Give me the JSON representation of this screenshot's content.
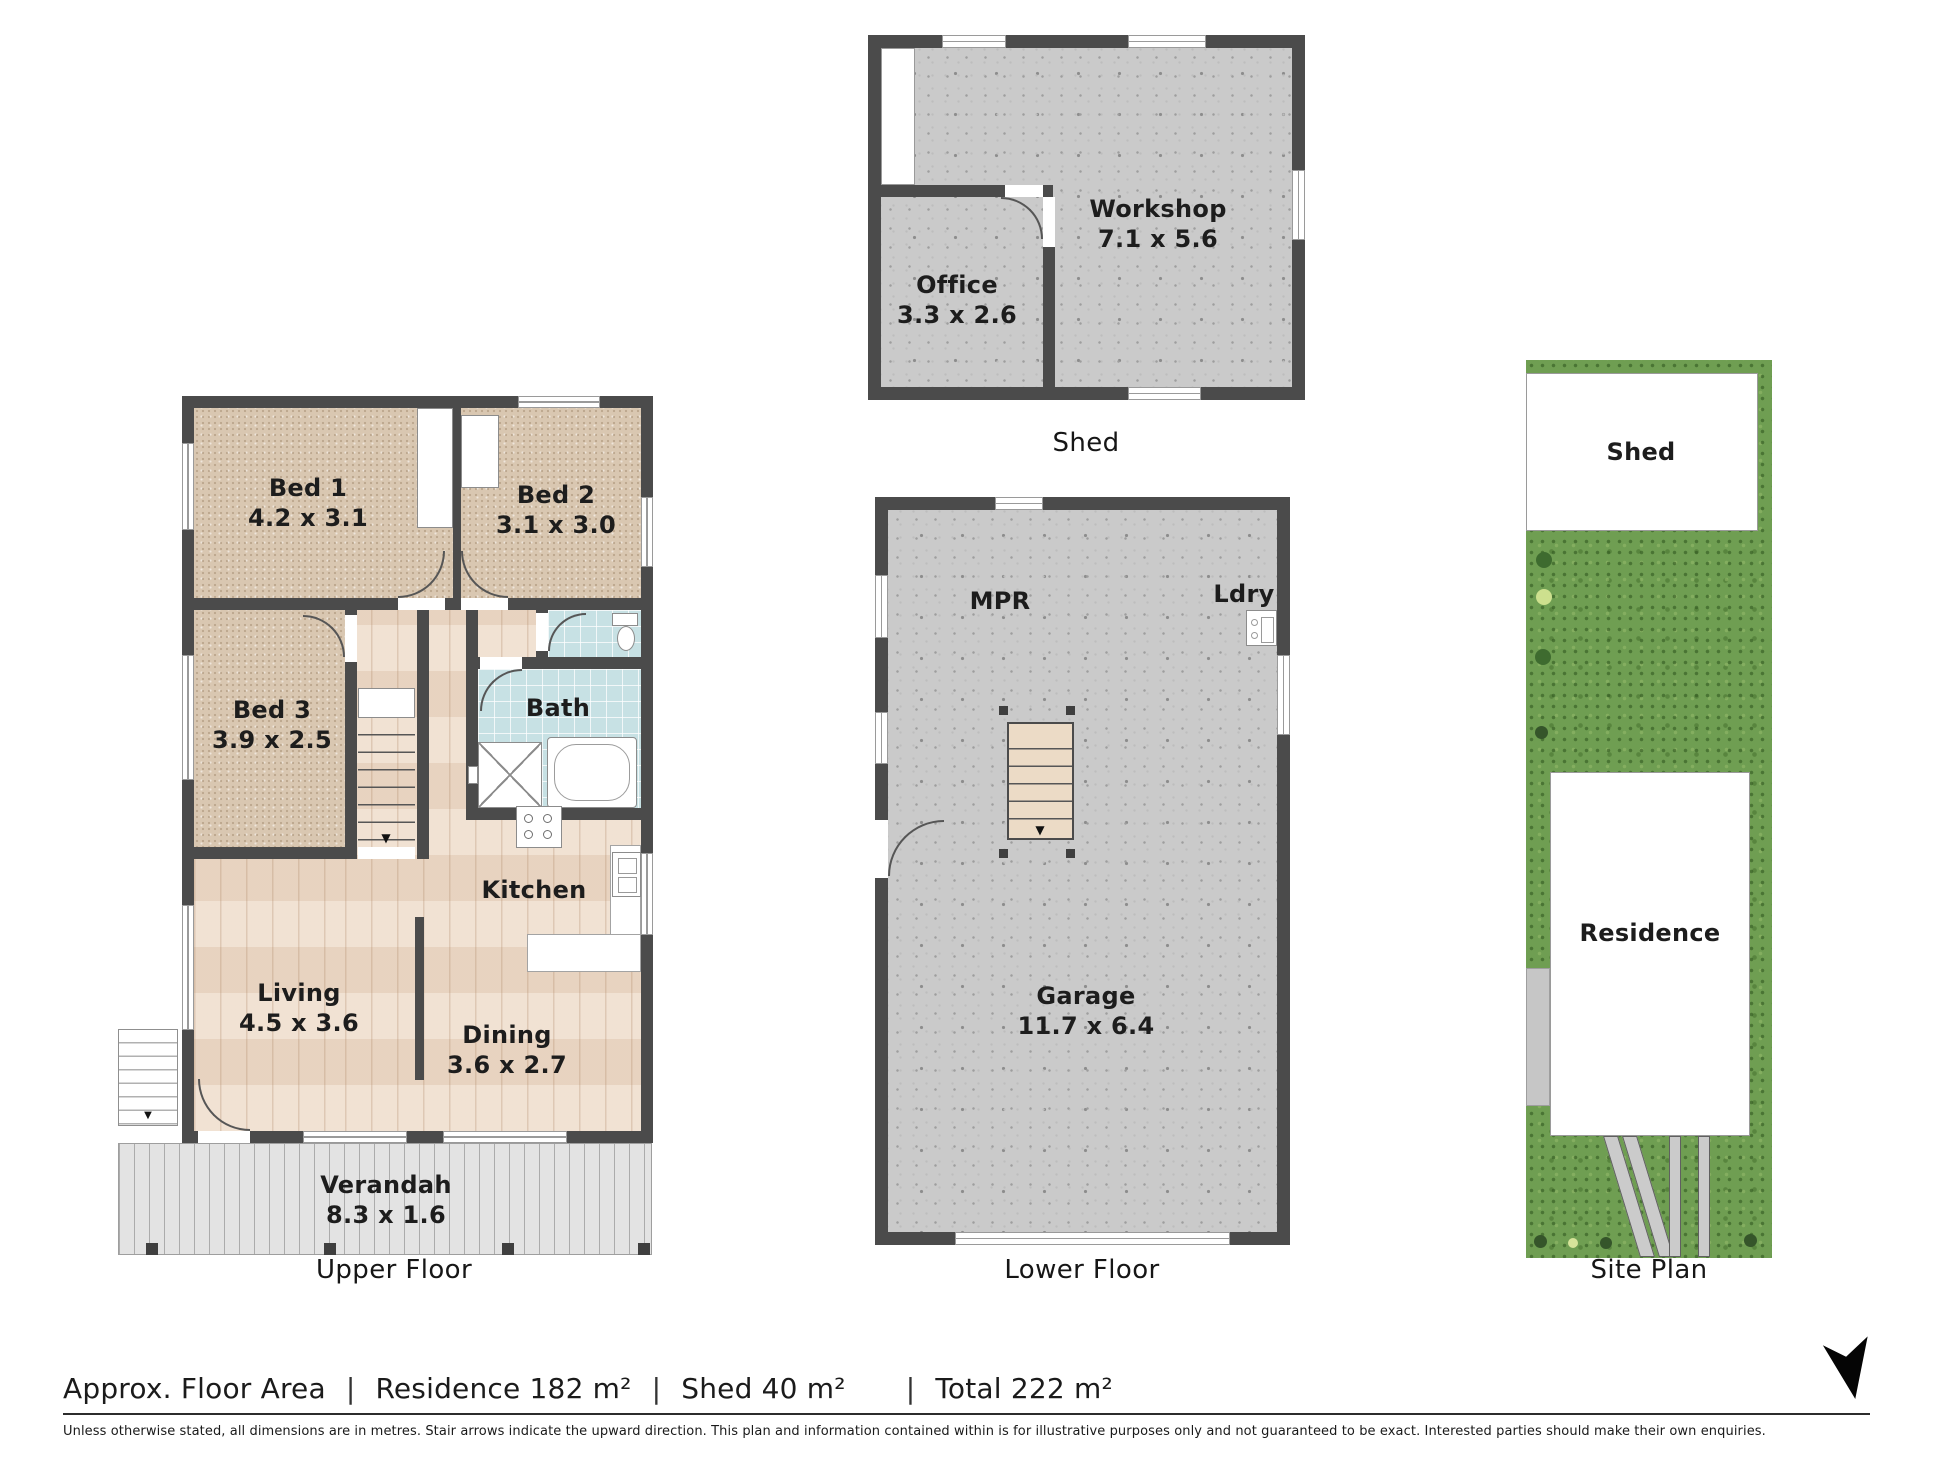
{
  "plans": {
    "upper": {
      "title": "Upper Floor",
      "rooms": {
        "bed1": {
          "name": "Bed 1",
          "dims": "4.2 x 3.1"
        },
        "bed2": {
          "name": "Bed 2",
          "dims": "3.1 x 3.0"
        },
        "bed3": {
          "name": "Bed 3",
          "dims": "3.9 x 2.5"
        },
        "bath": {
          "name": "Bath"
        },
        "kitchen": {
          "name": "Kitchen"
        },
        "living": {
          "name": "Living",
          "dims": "4.5 x 3.6"
        },
        "dining": {
          "name": "Dining",
          "dims": "3.6 x 2.7"
        },
        "verandah": {
          "name": "Verandah",
          "dims": "8.3 x 1.6"
        }
      }
    },
    "shed": {
      "title": "Shed",
      "rooms": {
        "office": {
          "name": "Office",
          "dims": "3.3 x 2.6"
        },
        "workshop": {
          "name": "Workshop",
          "dims": "7.1 x 5.6"
        }
      }
    },
    "lower": {
      "title": "Lower Floor",
      "rooms": {
        "mpr": {
          "name": "MPR"
        },
        "ldry": {
          "name": "Ldry"
        },
        "garage": {
          "name": "Garage",
          "dims": "11.7 x 6.4"
        }
      }
    },
    "site": {
      "title": "Site Plan",
      "labels": {
        "shed": "Shed",
        "residence": "Residence"
      }
    }
  },
  "footer": {
    "area_label": "Approx. Floor Area",
    "separator": "|",
    "residence": "Residence 182 m²",
    "shed": "Shed 40 m²",
    "total": "Total 222 m²",
    "disclaimer": "Unless otherwise stated, all dimensions are in metres. Stair arrows indicate the upward direction. This plan and information contained within is for illustrative purposes only and not guaranteed to be exact. Interested parties should make their own enquiries."
  },
  "icons": {
    "stair_up_arrow": "▼",
    "north_arrow": "north-arrow"
  },
  "colors": {
    "wall": "#4b4b4b",
    "carpet": "#d9c7b1",
    "timber": "#eedccb",
    "tile": "#c7e1e4",
    "concrete": "#cacaca",
    "deck": "#e3e3e3",
    "grass": "#6f9e52",
    "text": "#1d1d1d"
  }
}
